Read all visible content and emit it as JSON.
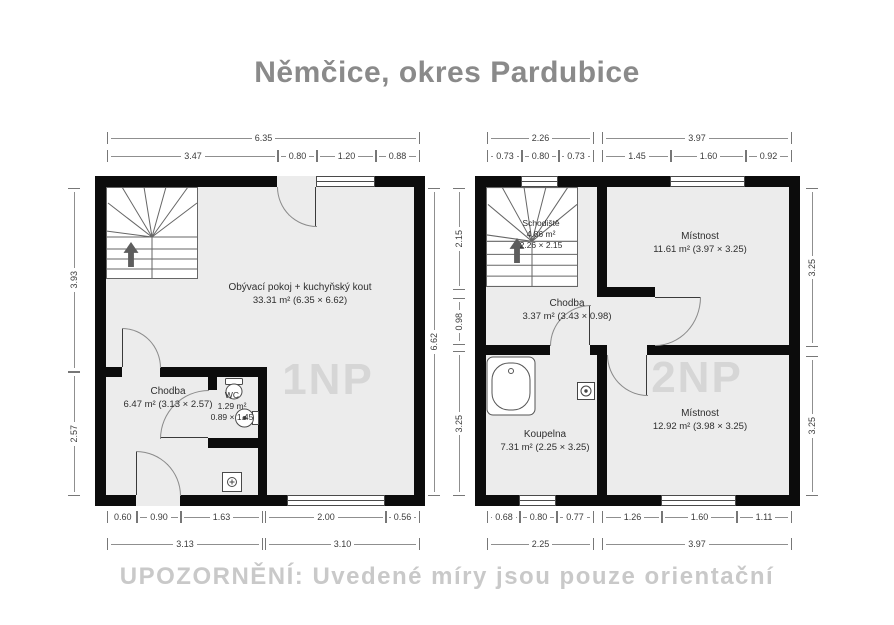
{
  "title": "Němčice, okres Pardubice",
  "disclaimer": "UPOZORNĚNÍ: Uvedené míry jsou pouze orientační",
  "colors": {
    "floor": "#ececec",
    "wall": "#0c0c0c",
    "dim_text": "#3c3c3c",
    "dim_line": "#8f8f8f",
    "title_text": "#8a8a8a",
    "disclaimer_text": "#c9c9c9",
    "watermark_text": "#d6d6d6",
    "fixture_line": "#555555"
  },
  "floors": [
    {
      "watermark": "1NP",
      "rooms": {
        "living": {
          "name": "Obývací pokoj + kuchyňský kout",
          "area": "33.31 m² (6.35 × 6.62)"
        },
        "hall": {
          "name": "Chodba",
          "area": "6.47 m² (3.13 × 2.57)"
        },
        "wc": {
          "name": "WC",
          "area": "1.29 m²",
          "size": "0.89 × 1.45"
        }
      },
      "dims": {
        "top1": [
          "6.35"
        ],
        "top2": [
          "3.47",
          "0.80",
          "1.20",
          "0.88"
        ],
        "left": [
          "3.93",
          "2.57"
        ],
        "right": [
          "6.62"
        ],
        "bottom1": [
          "0.60",
          "0.90",
          "1.63",
          "2.00",
          "0.56"
        ],
        "bottom2": [
          "3.13",
          "3.10"
        ]
      }
    },
    {
      "watermark": "2NP",
      "rooms": {
        "stairs": {
          "name": "Schodiště",
          "area": "4.86 m²",
          "size": "2.26 × 2.15"
        },
        "room1": {
          "name": "Místnost",
          "area": "11.61 m² (3.97 × 3.25)"
        },
        "hall": {
          "name": "Chodba",
          "area": "3.37 m² (3.43 × 0.98)"
        },
        "bathroom": {
          "name": "Koupelna",
          "area": "7.31 m² (2.25 × 3.25)"
        },
        "room2": {
          "name": "Místnost",
          "area": "12.92 m² (3.98 × 3.25)"
        }
      },
      "dims": {
        "top1": [
          "2.26",
          "3.97"
        ],
        "top2": [
          "0.73",
          "0.80",
          "0.73",
          "1.45",
          "1.60",
          "0.92"
        ],
        "left": [
          "2.15",
          "0.98",
          "3.25"
        ],
        "right": [
          "3.25",
          "3.25"
        ],
        "bottom1": [
          "0.68",
          "0.80",
          "0.77",
          "1.26",
          "1.60",
          "1.11"
        ],
        "bottom2": [
          "2.25",
          "3.97"
        ]
      }
    }
  ]
}
